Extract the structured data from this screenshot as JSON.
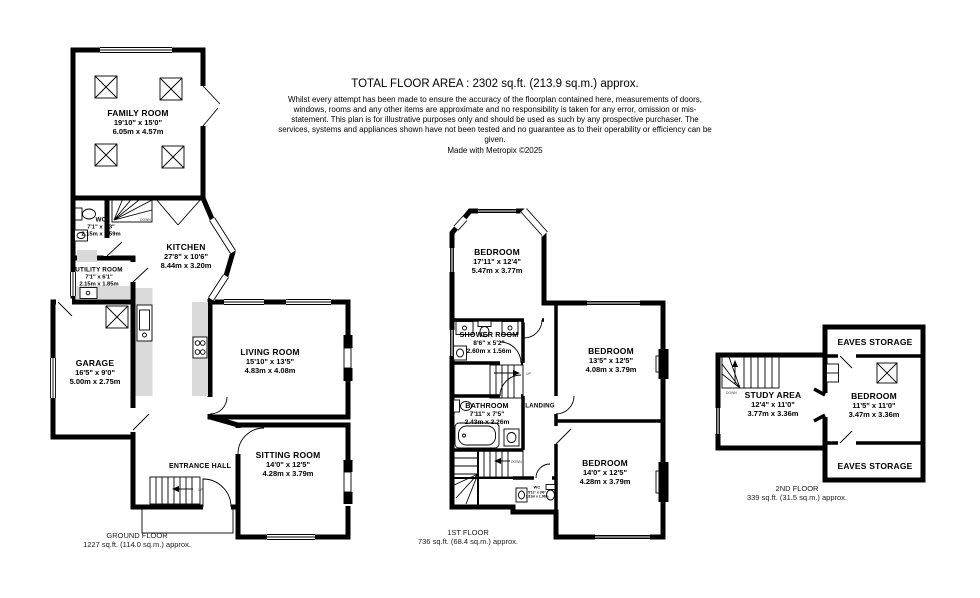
{
  "header": {
    "title": "TOTAL FLOOR AREA : 2302 sq.ft. (213.9 sq.m.) approx.",
    "disclaimer": "Whilst every attempt has been made to ensure the accuracy of the floorplan contained here, measurements of doors, windows, rooms and any other items are approximate and no responsibility is taken for any error, omission or mis-statement. This plan is for illustrative purposes only and should be used as such by any prospective purchaser. The services, systems and appliances shown have not been tested and no guarantee as to their operability or efficiency can be given.",
    "credit": "Made with Metropix ©2025"
  },
  "stairs": {
    "up": "UP",
    "down": "DOWN"
  },
  "floors": [
    {
      "label": "GROUND FLOOR",
      "area": "1227 sq.ft. (114.0 sq.m.) approx.",
      "rooms": [
        {
          "name": "FAMILY ROOM",
          "imperial": "19'10\" x 15'0\"",
          "metric": "6.05m x 4.57m"
        },
        {
          "name": "WC",
          "imperial": "7'1\" x 5'3\"",
          "metric": "2.15m x 1.59m"
        },
        {
          "name": "KITCHEN",
          "imperial": "27'8\" x 10'6\"",
          "metric": "8.44m x 3.20m"
        },
        {
          "name": "UTILITY ROOM",
          "imperial": "7'1\" x 6'1\"",
          "metric": "2.15m x 1.85m"
        },
        {
          "name": "GARAGE",
          "imperial": "16'5\" x 9'0\"",
          "metric": "5.00m x 2.75m"
        },
        {
          "name": "LIVING ROOM",
          "imperial": "15'10\" x 13'5\"",
          "metric": "4.83m x 4.08m"
        },
        {
          "name": "ENTRANCE HALL",
          "imperial": "",
          "metric": ""
        },
        {
          "name": "SITTING ROOM",
          "imperial": "14'0\" x 12'5\"",
          "metric": "4.28m x 3.79m"
        }
      ]
    },
    {
      "label": "1ST FLOOR",
      "area": "736 sq.ft. (68.4 sq.m.) approx.",
      "rooms": [
        {
          "name": "BEDROOM",
          "imperial": "17'11\" x 12'4\"",
          "metric": "5.47m x 3.77m"
        },
        {
          "name": "SHOWER ROOM",
          "imperial": "8'6\" x 5'2\"",
          "metric": "2.60m x 1.56m"
        },
        {
          "name": "BEDROOM",
          "imperial": "13'5\" x 12'5\"",
          "metric": "4.08m x 3.79m"
        },
        {
          "name": "BATHROOM",
          "imperial": "7'11\" x 7'5\"",
          "metric": "2.43m x 2.26m"
        },
        {
          "name": "LANDING",
          "imperial": "",
          "metric": ""
        },
        {
          "name": "BEDROOM",
          "imperial": "14'0\" x 12'5\"",
          "metric": "4.28m x 3.79m"
        },
        {
          "name": "WC",
          "imperial": "5'11\" x 3'6\"",
          "metric": "1.81m x 1.06m"
        }
      ]
    },
    {
      "label": "2ND FLOOR",
      "area": "339 sq.ft. (31.5 sq.m.) approx.",
      "rooms": [
        {
          "name": "EAVES STORAGE",
          "imperial": "",
          "metric": ""
        },
        {
          "name": "STUDY AREA",
          "imperial": "12'4\" x 11'0\"",
          "metric": "3.77m x 3.36m"
        },
        {
          "name": "BEDROOM",
          "imperial": "11'5\" x 11'0\"",
          "metric": "3.47m x 3.36m"
        },
        {
          "name": "EAVES STORAGE",
          "imperial": "",
          "metric": ""
        }
      ]
    }
  ]
}
